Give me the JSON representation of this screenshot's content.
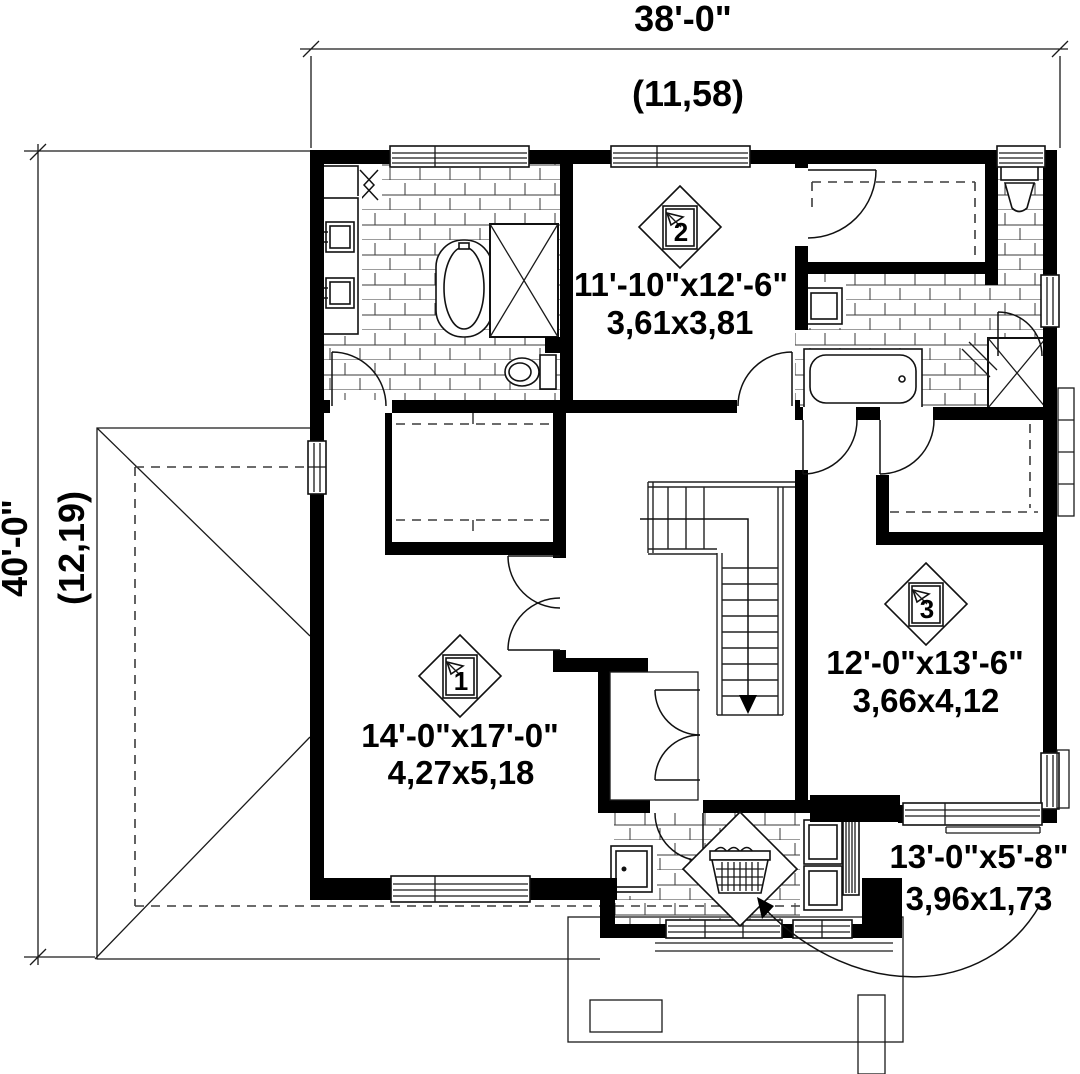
{
  "title": "Second floor plan",
  "colors": {
    "ink": "#000000",
    "paper": "#ffffff"
  },
  "dimensions": {
    "top": {
      "imperial": "38'-0\"",
      "metric": "(11,58)"
    },
    "left": {
      "imperial": "40'-0\"",
      "metric": "(12,19)"
    }
  },
  "rooms": [
    {
      "marker": "1",
      "imperial": "14'-0\"x17'-0\"",
      "metric": "4,27x5,18"
    },
    {
      "marker": "2",
      "imperial": "11'-10\"x12'-6\"",
      "metric": "3,61x3,81"
    },
    {
      "marker": "3",
      "imperial": "12'-0\"x13'-6\"",
      "metric": "3,66x4,12"
    }
  ],
  "laundry": {
    "imperial": "13'-0\"x5'-8\"",
    "metric": "3,96x1,73"
  },
  "icons": {
    "laundry_basket": "laundry-basket-icon",
    "stair_down_arrow": "stair-direction-arrow",
    "room_markers": [
      "room-marker-1",
      "room-marker-2",
      "room-marker-3"
    ]
  }
}
